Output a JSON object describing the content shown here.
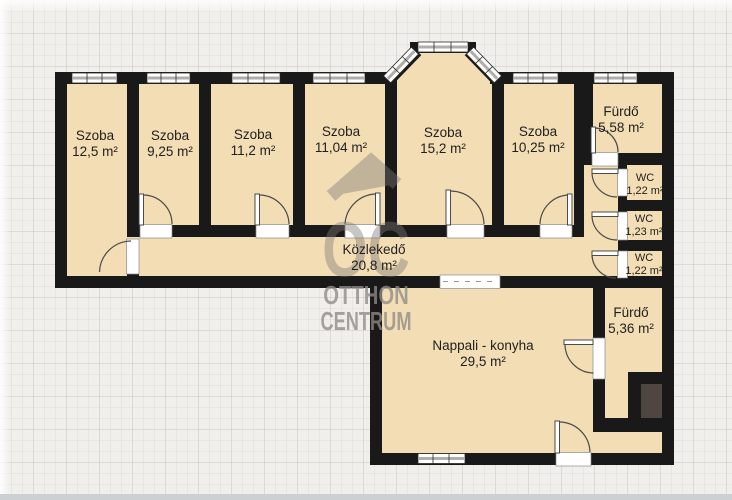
{
  "plan": {
    "rooms": [
      {
        "id": "szoba-1",
        "name": "Szoba",
        "area": "12,5 m²"
      },
      {
        "id": "szoba-2",
        "name": "Szoba",
        "area": "9,25 m²"
      },
      {
        "id": "szoba-3",
        "name": "Szoba",
        "area": "11,2 m²"
      },
      {
        "id": "szoba-4",
        "name": "Szoba",
        "area": "11,04 m²"
      },
      {
        "id": "szoba-5",
        "name": "Szoba",
        "area": "15,2 m²"
      },
      {
        "id": "szoba-6",
        "name": "Szoba",
        "area": "10,25 m²"
      },
      {
        "id": "furdo-1",
        "name": "Fürdő",
        "area": "5,58 m²"
      },
      {
        "id": "wc-1",
        "name": "WC",
        "area": "1,22 m²"
      },
      {
        "id": "wc-2",
        "name": "WC",
        "area": "1,23 m²"
      },
      {
        "id": "wc-3",
        "name": "WC",
        "area": "1,22 m²"
      },
      {
        "id": "kozlekedo",
        "name": "Közlekedő",
        "area": "20,8 m²"
      },
      {
        "id": "nappali",
        "name": "Nappali - konyha",
        "area": "29,5 m²"
      },
      {
        "id": "furdo-2",
        "name": "Fürdő",
        "area": "5,36 m²"
      }
    ],
    "watermark": {
      "logo": "OC",
      "line1": "OTTHON",
      "line2": "CENTRUM"
    },
    "colors": {
      "floor": "#f3ddb4",
      "wall": "#191919",
      "shaft": "#4f4541",
      "background": "#f0efec",
      "watermark": "#8f8c86"
    }
  }
}
